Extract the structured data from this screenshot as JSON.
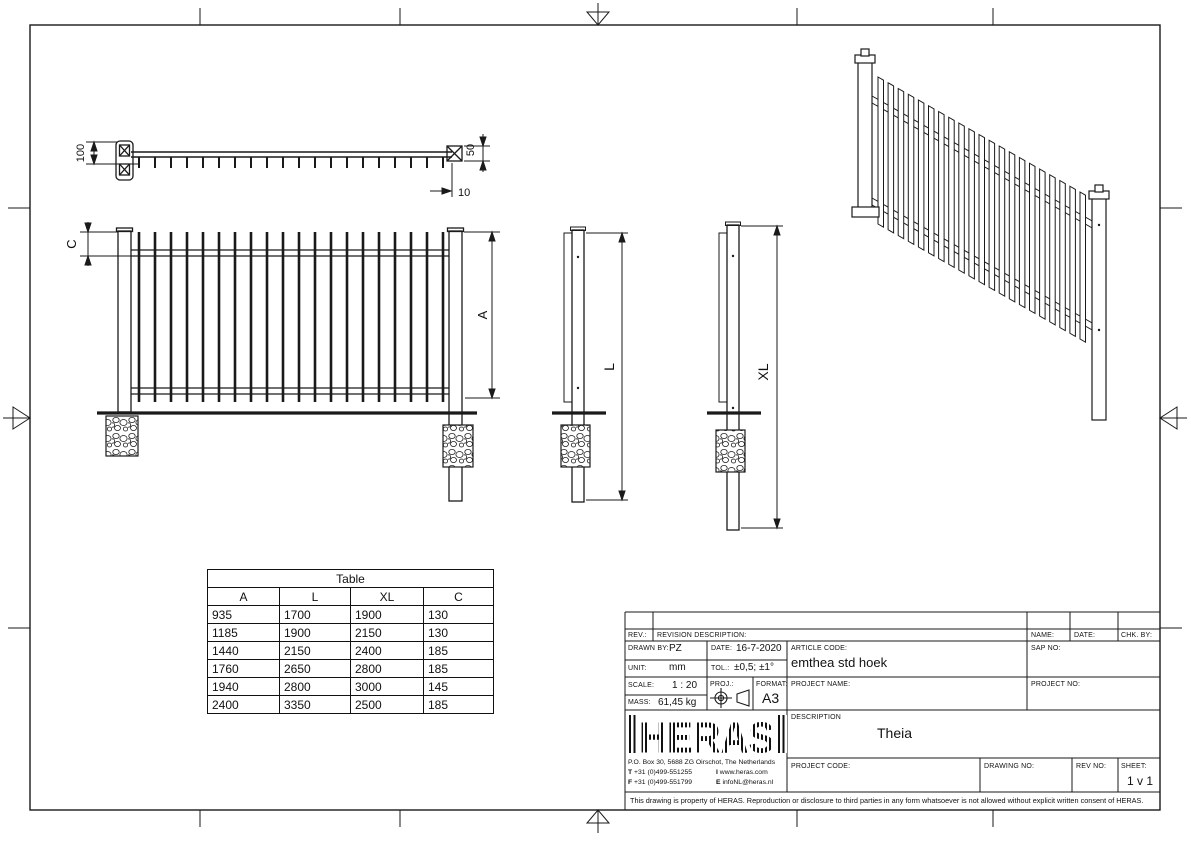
{
  "colors": {
    "line": "#1a1a1a",
    "background": "#ffffff"
  },
  "dims": {
    "top_depth": "100",
    "post_offset": "50",
    "picket_gap": "10",
    "top_clearance": "C",
    "panel_height": "A",
    "post_length": "L",
    "post_length_xl": "XL"
  },
  "table": {
    "title": "Table",
    "columns": [
      "A",
      "L",
      "XL",
      "C"
    ],
    "rows": [
      [
        "935",
        "1700",
        "1900",
        "130"
      ],
      [
        "1185",
        "1900",
        "2150",
        "130"
      ],
      [
        "1440",
        "2150",
        "2400",
        "185"
      ],
      [
        "1760",
        "2650",
        "2800",
        "185"
      ],
      [
        "1940",
        "2800",
        "3000",
        "145"
      ],
      [
        "2400",
        "3350",
        "2500",
        "185"
      ]
    ]
  },
  "title_block": {
    "rev_label": "REV.:",
    "revision_description_label": "REVISION DESCRIPTION:",
    "name_label": "NAME:",
    "date_col_label": "DATE:",
    "chk_by_label": "CHK. BY:",
    "drawn_by_label": "DRAWN BY:",
    "drawn_by": "PZ",
    "date_label": "DATE:",
    "date": "16-7-2020",
    "unit_label": "UNIT:",
    "unit": "mm",
    "tol_label": "TOL.:",
    "tol": "±0,5; ±1°",
    "article_code_label": "ARTICLE CODE:",
    "article_code": "emthea std hoek",
    "sap_no_label": "SAP NO:",
    "scale_label": "SCALE:",
    "scale": "1 : 20",
    "mass_label": "MASS:",
    "mass": "61,45 kg",
    "proj_label": "PROJ.:",
    "format_label": "FORMAT:",
    "format": "A3",
    "project_name_label": "PROJECT NAME:",
    "project_no_label": "PROJECT NO:",
    "description_label": "DESCRIPTION",
    "description": "Theia",
    "project_code_label": "PROJECT CODE:",
    "drawing_no_label": "DRAWING NO:",
    "rev_no_label": "REV NO:",
    "sheet_label": "SHEET:",
    "sheet": "1 v 1",
    "disclaimer": "This drawing is property of HERAS. Reproduction or disclosure to third parties in any form whatsoever is not allowed without explicit written consent of HERAS.",
    "company": {
      "logo_text": "HERAS",
      "address": "P.O. Box 30, 5688 ZG Oirschot, The Netherlands",
      "tel_label": "T",
      "tel": "+31 (0)499-551255",
      "web_label": "I",
      "web": "www.heras.com",
      "fax_label": "F",
      "fax": "+31 (0)499-551799",
      "email_label": "E",
      "email": "infoNL@heras.nl"
    }
  }
}
